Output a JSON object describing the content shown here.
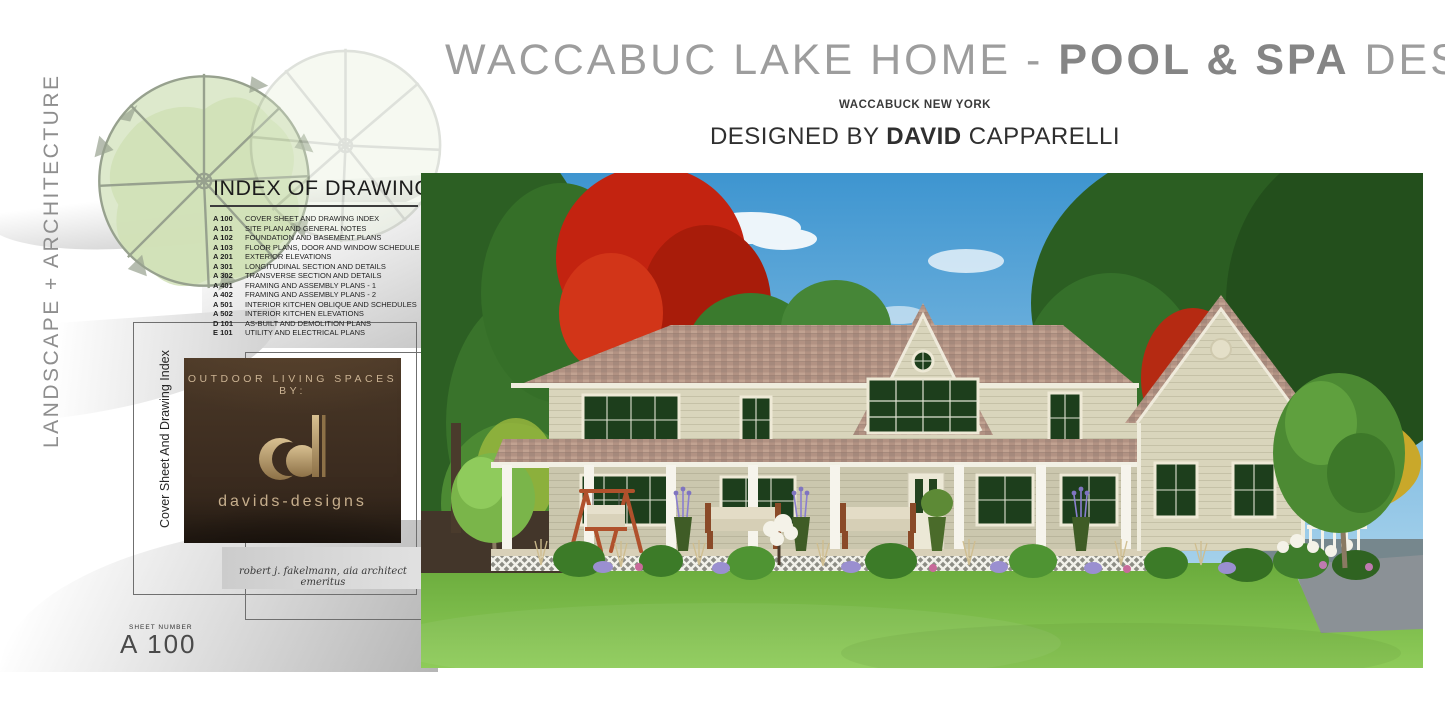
{
  "header": {
    "title_part1": "WACCABUC LAKE HOME  - ",
    "title_strong": "POOL & SPA",
    "title_part3": " DESIGN",
    "location": "WACCABUCK NEW YORK",
    "designed_prefix": "DESIGNED BY ",
    "designer_first": "DAVID",
    "designer_last": " CAPPARELLI"
  },
  "side_label": "LANDSCAPE + ARCHITECTURE",
  "cover_label": "Cover Sheet And Drawing Index",
  "index": {
    "title": "INDEX OF DRAWINGS",
    "rows": [
      {
        "code": "A 100",
        "title": "COVER SHEET AND DRAWING INDEX"
      },
      {
        "code": "A 101",
        "title": "SITE PLAN AND GENERAL NOTES"
      },
      {
        "code": "A 102",
        "title": "FOUNDATION AND BASEMENT PLANS"
      },
      {
        "code": "A 103",
        "title": "FLOOR PLANS, DOOR AND WINDOW SCHEDULE"
      },
      {
        "code": "A 201",
        "title": "EXTERIOR ELEVATIONS"
      },
      {
        "code": "A 301",
        "title": "LONGITUDINAL SECTION AND DETAILS"
      },
      {
        "code": "A 302",
        "title": "TRANSVERSE SECTION AND DETAILS"
      },
      {
        "code": "A 401",
        "title": "FRAMING AND ASSEMBLY PLANS - 1"
      },
      {
        "code": "A 402",
        "title": "FRAMING AND ASSEMBLY PLANS - 2"
      },
      {
        "code": "A 501",
        "title": "INTERIOR KITCHEN OBLIQUE AND SCHEDULES"
      },
      {
        "code": "A 502",
        "title": "INTERIOR KITCHEN ELEVATIONS"
      },
      {
        "code": "D 101",
        "title": "AS-BUILT AND DEMOLITION PLANS"
      },
      {
        "code": "E 101",
        "title": "UTILITY AND ELECTRICAL PLANS"
      }
    ]
  },
  "brand_panel": {
    "heading": "OUTDOOR LIVING SPACES BY:",
    "brand_name": "davids-designs"
  },
  "signature": "robert j. fakelmann, aia architect emeritus",
  "sheet_number": {
    "label": "SHEET NUMBER",
    "value": "A 100"
  },
  "colors": {
    "title_gray": "#9d9d9d",
    "panel_brown": "#3d2d20",
    "logo_gold": "#c2a878",
    "tree_symbol_green": "#dcead0",
    "sky_blue": "#4498d2",
    "lawn_green": "#7ab648",
    "roof_shingle": "#b29283",
    "siding_tan": "#d9d5bc",
    "maple_red": "#c32310"
  }
}
